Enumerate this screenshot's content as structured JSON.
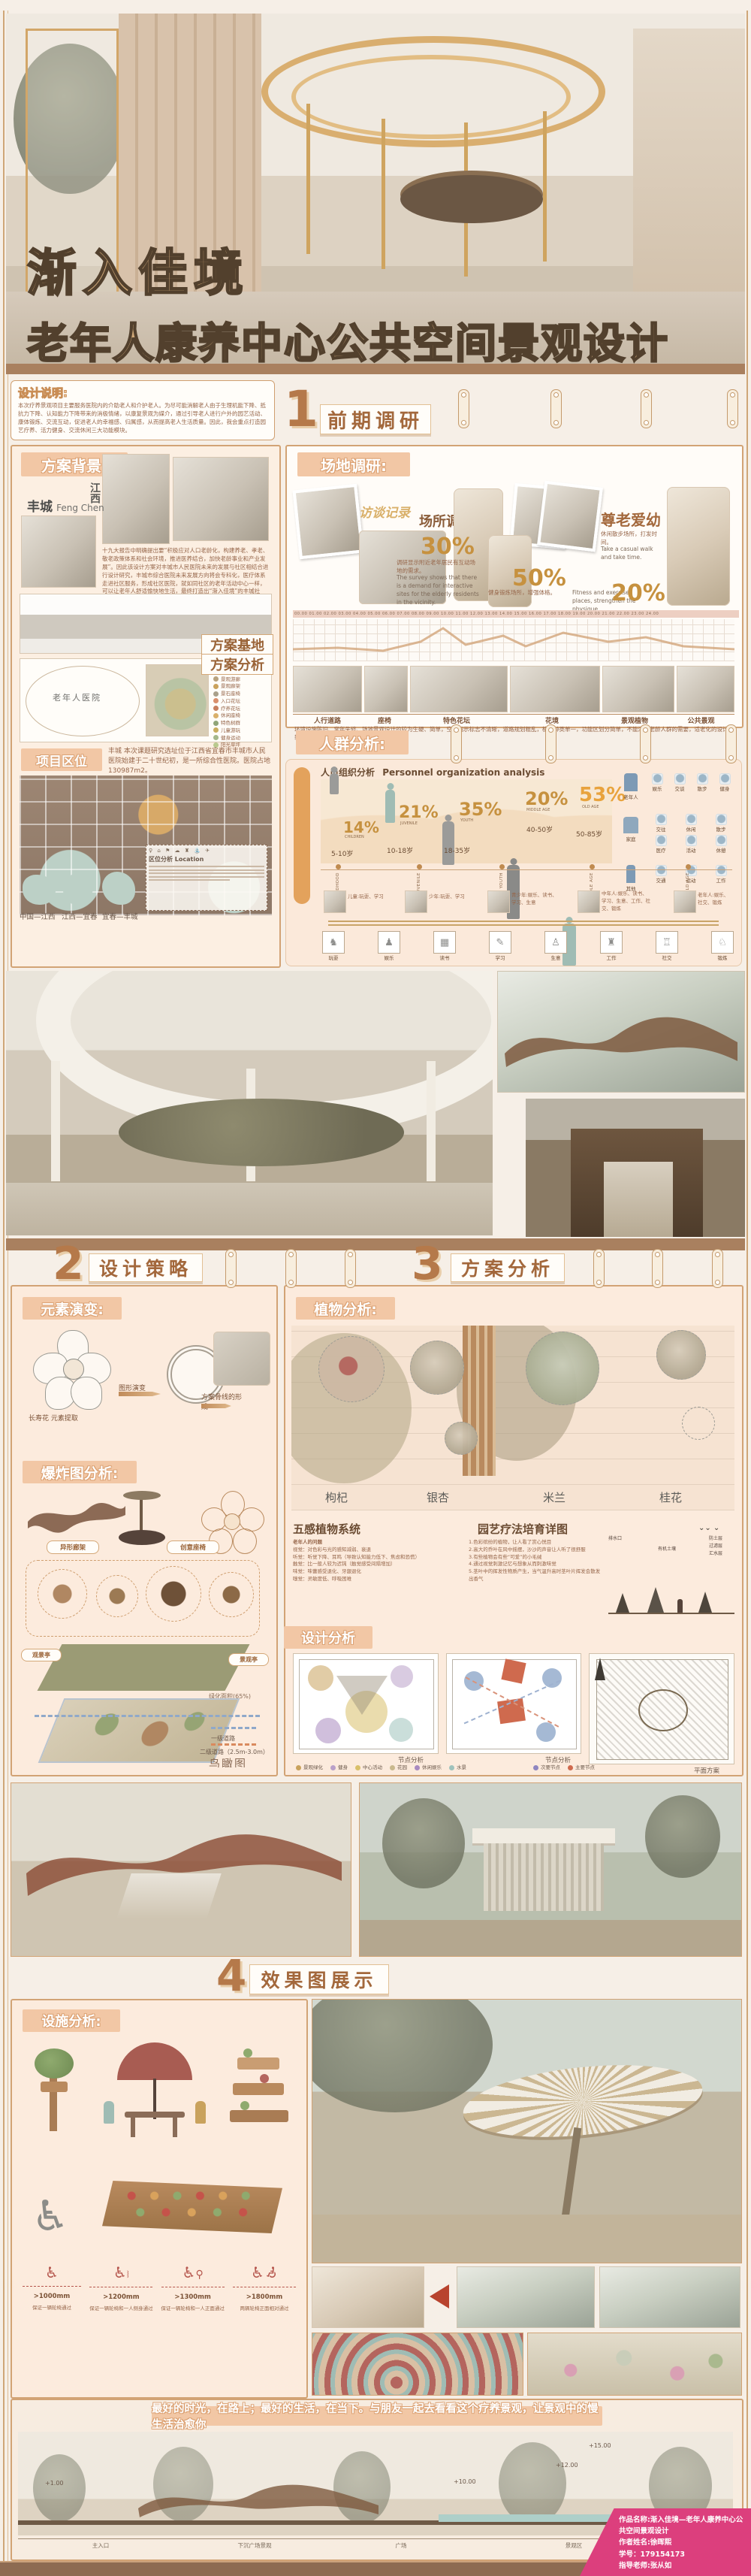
{
  "poster": {
    "title_line1": "渐入佳境",
    "title_line2": "老年人康养中心公共空间景观设计",
    "subtitle_en": "Gradually enter blissful circumstances--Landscape design of public space in elderly rehabilitation center"
  },
  "design_note": {
    "label": "设计说明:",
    "body": "本次疗养景观项目主要服务医院内的介助老人和介护老人。为尽可能消解老人由于生理机能下降、抵抗力下降、认知能力下降带来的消极情绪，以康复景观为媒介，通过引导老人进行户外的园艺活动、康体锻炼、交流互动，促进老人的幸福感、归属感，从而提高老人生活质量。因此，我会重点打造园艺疗养、活力健身、交流休闲三大功能模块。"
  },
  "sections": {
    "s1": {
      "num": "1",
      "label": "前期调研"
    },
    "s2": {
      "num": "2",
      "label": "设计策略"
    },
    "s3": {
      "num": "3",
      "label": "方案分析"
    },
    "s4": {
      "num": "4",
      "label": "效果图展示"
    }
  },
  "background": {
    "label": "方案背景:",
    "city": "丰城",
    "city_en": "Feng Chen",
    "province": "江西",
    "body": "十九大报告中明确提出要“积极应对人口老龄化，构建养老、孝老、敬老政策体系和社会环境，推进医养结合，加快老龄事业和产业发展”。因此该设计方案对丰城市人民医院未来的发展与社区相结合进行设计研究，丰城市综合医院未来发展方向将会专科化，医疗体系走进社区服务，形成社区医院，就如同社区的老年活动中心一样，可以让老年人舒适愉快地生活，最终打造出“渐入佳境”的丰城社区。",
    "base_label": "方案基地",
    "analysis_label": "方案分析",
    "bubble_center": "老年人医院",
    "legend": [
      "停车场",
      "广场",
      "景观游廊",
      "景观廊架",
      "景石座椅",
      "入口花坛",
      "疗养花坛",
      "休闲座椅",
      "特色树群",
      "儿童游玩",
      "健身运动",
      "阳光草坪"
    ]
  },
  "location": {
    "label": "项目区位",
    "body": "丰城 本次课题研究选址位于江西省宜春市丰城市人民医院始建于二十世纪初，是一所综合性医院。医院占地130987m2。",
    "legend_title": "区位分析 Location",
    "maps": [
      "中国—江西",
      "江西—宜春",
      "宜春—丰城"
    ]
  },
  "site": {
    "label": "场地调研:",
    "interview": "访谈记录",
    "survey": "场所调研",
    "respect": "尊老爱幼",
    "stats": [
      {
        "pct": "30%",
        "zh": "调研显示附近老年居民有互动场地的需求。",
        "en": "The survey shows that there is a demand for interactive sites for the elderly residents in the vicinity."
      },
      {
        "pct": "50%",
        "zh": "健身锻炼场所，增强体格。",
        "en": "Fitness and exercise places, strengthen the physique."
      },
      {
        "pct": "20%",
        "zh": "休闲散步场所，打发时间。",
        "en": "Take a casual walk and take time."
      }
    ],
    "timeline": "00.00 01.00 02.00 03.00 04.00 05.00 06.00 07.00 08.00 09.00 10.00 11.00 12.00 13.00 14.00 15.00 16.00 17.00 18.00 19.00 20.00 21.00 22.00 23.00 24.00",
    "strip": [
      "人行道路",
      "座椅",
      "特色花坛",
      "花境",
      "景观植物",
      "公共景观"
    ],
    "strip_caption": "环境设施陈旧、常年失修、场地景观设计的较为生硬、简单，空间指示标志不清晰，道路规划粗乱，植物种类单一，功能区划分简单，不能满足老龄人群的需要，适老化的设计较少，空间缺乏趣味性。"
  },
  "crowd": {
    "label": "人群分析:",
    "org_title_zh": "人员组织分析",
    "org_title_en": "Personnel organization analysis",
    "groups": [
      {
        "pct": "14%",
        "en": "CHILDREN",
        "age": "5-10岁"
      },
      {
        "pct": "21%",
        "en": "JUVENILE",
        "age": "10-18岁"
      },
      {
        "pct": "35%",
        "en": "YOUTH",
        "age": "18-35岁"
      },
      {
        "pct": "20%",
        "en": "MIDDLE AGE",
        "age": "40-50岁"
      },
      {
        "pct": "53%",
        "en": "OLD AGE",
        "age": "50-85岁"
      }
    ],
    "icon_groups": [
      {
        "label": "老年人",
        "items": [
          "娱乐",
          "交谈",
          "散步",
          "健身"
        ]
      },
      {
        "label": "家庭",
        "items": [
          "交往",
          "休闲",
          "散步",
          "医疗",
          "活动",
          "休憩"
        ]
      },
      {
        "label": "其他",
        "items": [
          "交通",
          "运动",
          "工作"
        ]
      }
    ],
    "stages": [
      {
        "en": "CHILDHOOD",
        "desc": "儿童:玩耍、学习"
      },
      {
        "en": "JUVENILE",
        "desc": "少年:玩耍、学习"
      },
      {
        "en": "YOUTH",
        "desc": "青少年:娱乐、读书、学习、生意"
      },
      {
        "en": "MIDDLE AGE",
        "desc": "中年人:娱乐、读书、学习、生意、工作、社交、锻炼"
      },
      {
        "en": "OLD AGE",
        "desc": "老年人:娱乐、社交、锻炼"
      }
    ],
    "activities": [
      "玩耍",
      "娱乐",
      "读书",
      "学习",
      "生意",
      "工作",
      "社交",
      "锻炼"
    ]
  },
  "strategy": {
    "element_label": "元素演变:",
    "step1": "长寿花 元素提取",
    "step2": "图形演变",
    "step3": "方案骨线的形成",
    "exploded_label": "爆炸图分析:",
    "callout1": "异形廊架",
    "callout2": "创意座椅",
    "pavilion1": "观景亭",
    "pavilion2": "景观亭",
    "green": "绿化面积(65%)",
    "road1": "一级道路",
    "road2": "二级道路（2.5m-3.0m）",
    "birdseye": "鸟瞰图"
  },
  "plan": {
    "plant_label": "植物分析:",
    "plants": [
      "枸杞",
      "银杏",
      "米兰",
      "桂花"
    ],
    "senses_title": "五感植物系统",
    "senses_left": [
      "老年人的问题",
      "视觉：对色彩与光的感知减弱、衰退",
      "听觉：听觉下降、耳鸣（导致认知能力低下、焦虑和恐慌）",
      "触觉：比一般人较为迟钝（触觉感受间隔增加）",
      "味觉：味蕾感受退化、牙龈退化",
      "嗅觉：灵敏度低、呼吸困难"
    ],
    "senses_right": [
      "1.色彩缤纷的植物，让人看了赏心悦目",
      "2.高大的乔叶在风中摇摆，沙沙的声音让人听了很舒服",
      "3.有些植物会有些“可爱”的小毛绒",
      "4.通过视觉刺激记忆与想象从而刺激味觉",
      "5.茎叶中的挥发性物质产生，当气温升高时茎叶片挥发会散发出香气"
    ],
    "therapy_title": "园艺疗法培育详图",
    "therapy_labels": [
      "排水口",
      "有机土壤",
      "防土层",
      "过滤层",
      "汇水层"
    ],
    "design_label": "设计分析",
    "plan_captions": [
      "节点分析",
      "节点分析",
      "平面方案"
    ],
    "legend_zones": [
      "景观绿化",
      "健身",
      "中心活动",
      "花园",
      "休闲娱乐",
      "水景"
    ],
    "legend_nodes": [
      "次要节点",
      "主要节点"
    ]
  },
  "facility": {
    "label": "设施分析:",
    "access": [
      {
        "dim": ">1000mm",
        "cap": "保证一辆轮椅通过"
      },
      {
        "dim": ">1200mm",
        "cap": "保证一辆轮椅和一人侧身通过"
      },
      {
        "dim": ">1300mm",
        "cap": "保证一辆轮椅和一人正面通过"
      },
      {
        "dim": ">1800mm",
        "cap": "两辆轮椅正面相对通过"
      }
    ]
  },
  "footer": {
    "quote": "最好的时光，在路上；最好的生活，在当下。与朋友一起去看看这个疗养景观，让景观中的慢生活治愈你",
    "marks": [
      "+15.00",
      "+12.00",
      "+10.00",
      "+1.00"
    ],
    "elev_labels": [
      "主入口",
      "下沉广场景观",
      "广场",
      "景观区"
    ],
    "credits": [
      "作品名称:渐入佳境—老年人康养中心公共空间景观设计",
      "作者姓名:徐晖熙",
      "学号：179154173",
      "指导老师:张从如"
    ]
  },
  "colors": {
    "accent_brown": "#a9805f",
    "chip": "#f2c7a5",
    "gold": "#c6913f",
    "old_age_orange": "#e8a33d",
    "credit_pink": "#dc3f7d"
  }
}
